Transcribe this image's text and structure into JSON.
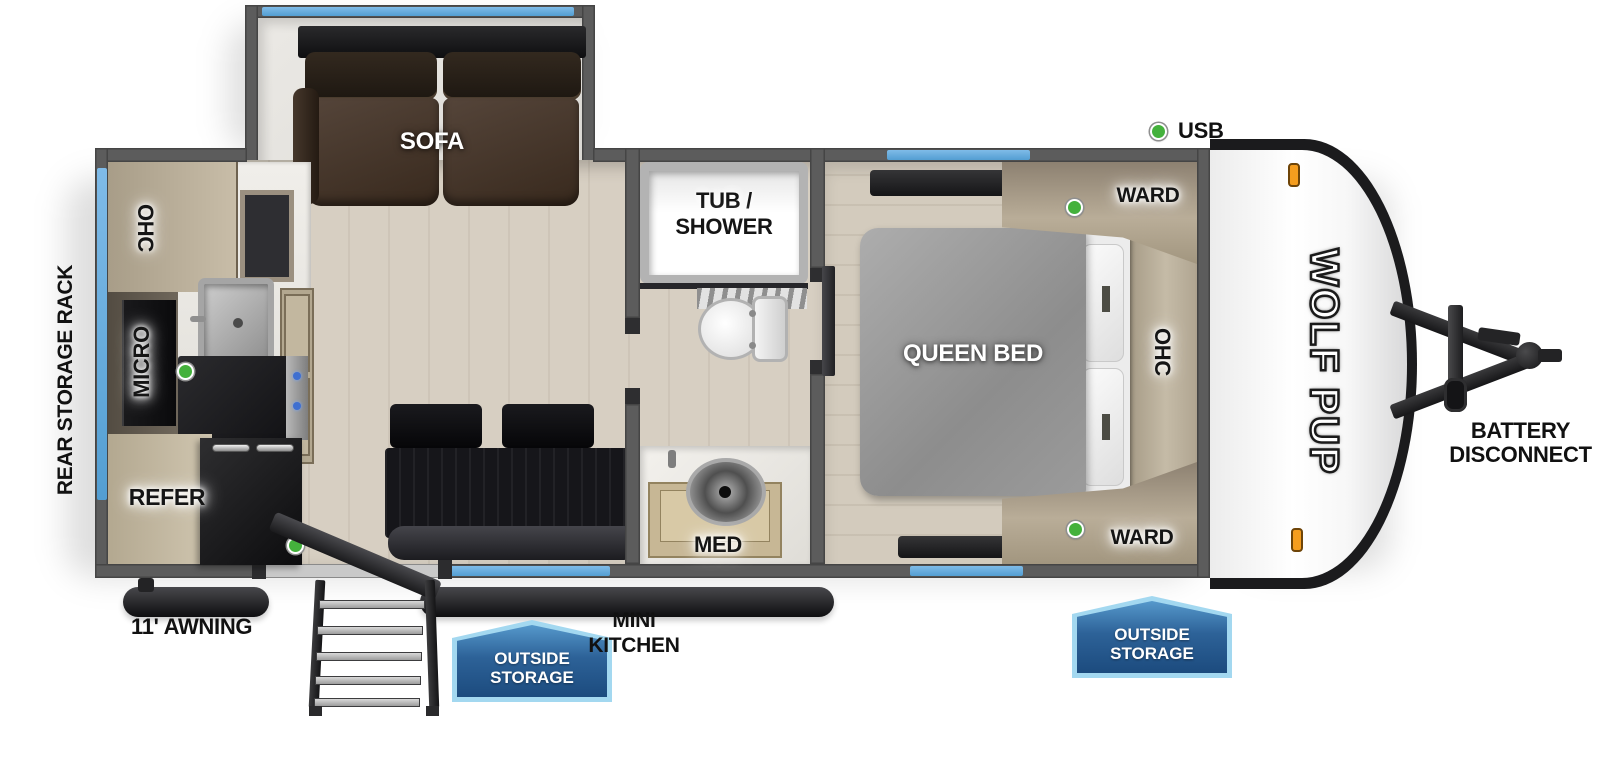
{
  "title": "Wolf Pup travel trailer floorplan",
  "brand": {
    "logo_text": "WOLF PUP"
  },
  "legend": {
    "usb": "USB"
  },
  "exterior": {
    "rear_storage_rack": "REAR STORAGE RACK",
    "awning": "11' AWNING",
    "mini_kitchen": [
      "MINI",
      "KITCHEN"
    ],
    "outside_storage_door": [
      "OUTSIDE",
      "STORAGE"
    ],
    "outside_storage_front": [
      "OUTSIDE",
      "STORAGE"
    ],
    "battery_disconnect": [
      "BATTERY",
      "DISCONNECT"
    ]
  },
  "living": {
    "sofa": "SOFA"
  },
  "kitchen": {
    "overhead_cabinet": "OHC",
    "microwave": "MICRO",
    "refrigerator": "REFER"
  },
  "bathroom": {
    "tub_shower": [
      "TUB /",
      "SHOWER"
    ],
    "medicine_cabinet": "MED"
  },
  "bedroom": {
    "bed": "QUEEN BED",
    "wardrobe_top": "WARD",
    "wardrobe_bottom": "WARD",
    "overhead_cabinet": "OHC"
  },
  "colors": {
    "window_blue": "#64a8dc",
    "badge_blue_dark": "#1c4b7e",
    "badge_blue_light": "#5598cb",
    "badge_border": "#a3d8f0",
    "usb_green": "#44b13c",
    "marker_orange": "#f59d1e"
  }
}
